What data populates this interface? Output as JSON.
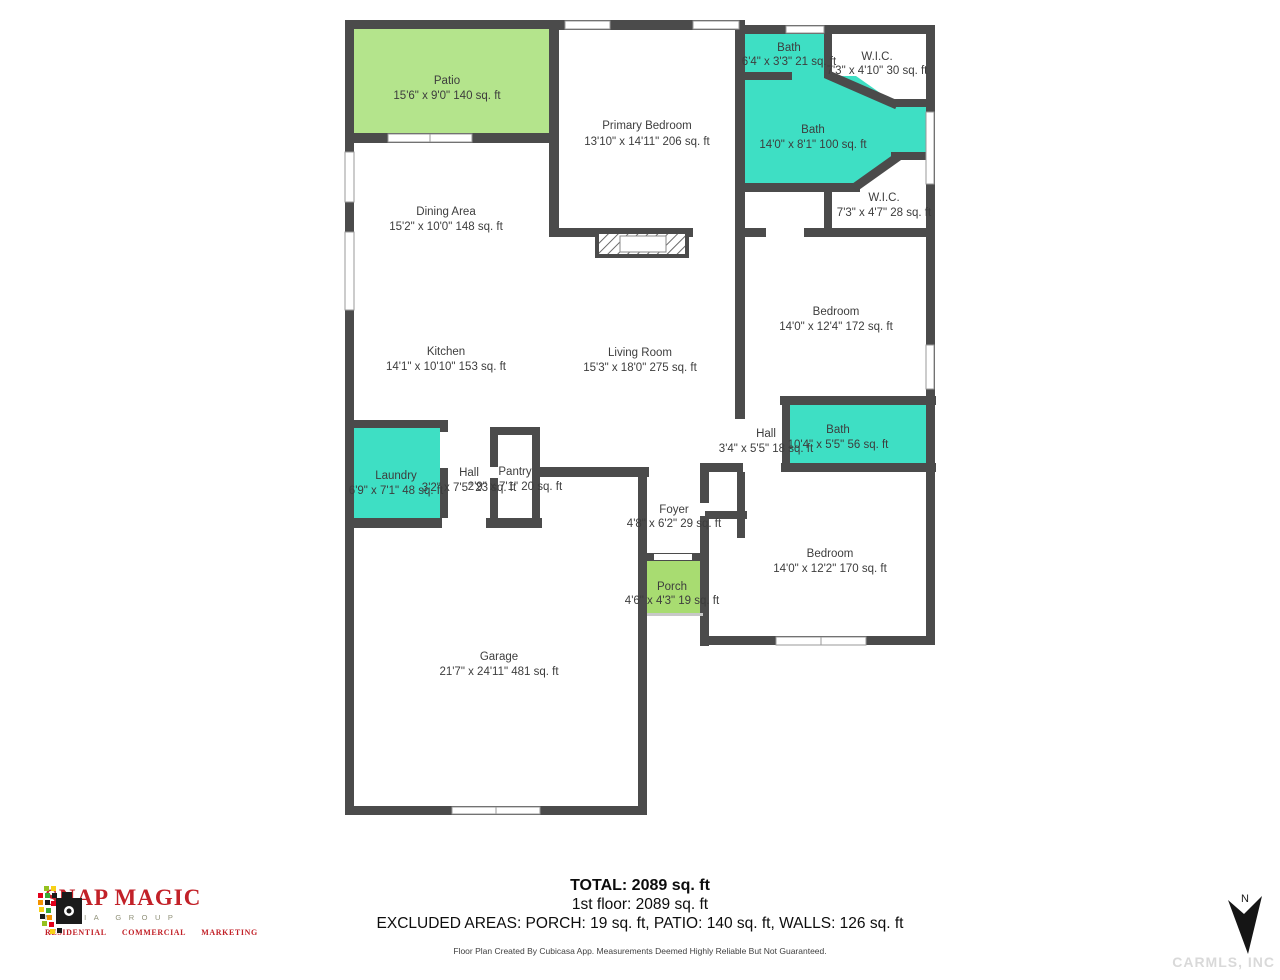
{
  "plan": {
    "rooms": {
      "patio": {
        "name": "Patio",
        "dims": "15'6\" x 9'0\" 140 sq. ft"
      },
      "primary": {
        "name": "Primary Bedroom",
        "dims": "13'10\" x 14'11\" 206 sq. ft"
      },
      "bath1": {
        "name": "Bath",
        "dims": "6'4\" x 3'3\" 21 sq. ft"
      },
      "wic1": {
        "name": "W.I.C.",
        "dims": "7'3\" x 4'10\" 30 sq. ft"
      },
      "bath2": {
        "name": "Bath",
        "dims": "14'0\" x 8'1\" 100 sq. ft"
      },
      "wic2": {
        "name": "W.I.C.",
        "dims": "7'3\" x 4'7\" 28 sq. ft"
      },
      "dining": {
        "name": "Dining Area",
        "dims": "15'2\" x 10'0\" 148 sq. ft"
      },
      "bedroom1": {
        "name": "Bedroom",
        "dims": "14'0\" x 12'4\" 172 sq. ft"
      },
      "kitchen": {
        "name": "Kitchen",
        "dims": "14'1\" x 10'10\" 153 sq. ft"
      },
      "living": {
        "name": "Living Room",
        "dims": "15'3\" x 18'0\" 275 sq. ft"
      },
      "hall1": {
        "name": "Hall",
        "dims": "3'4\" x 5'5\" 18 sq. ft"
      },
      "bath3": {
        "name": "Bath",
        "dims": "10'4\" x 5'5\" 56 sq. ft"
      },
      "laundry": {
        "name": "Laundry",
        "dims": "6'9\" x 7'1\" 48 sq. ft"
      },
      "hall2": {
        "name": "Hall",
        "dims": "3'2\" x 7'5\" 23 sq. ft"
      },
      "pantry": {
        "name": "Pantry",
        "dims": "2'9\" x 7'1\" 20 sq. ft"
      },
      "foyer": {
        "name": "Foyer",
        "dims": "4'8\" x 6'2\" 29 sq. ft"
      },
      "porch": {
        "name": "Porch",
        "dims": "4'6\" x 4'3\" 19 sq. ft"
      },
      "bedroom2": {
        "name": "Bedroom",
        "dims": "14'0\" x 12'2\" 170 sq. ft"
      },
      "garage": {
        "name": "Garage",
        "dims": "21'7\" x 24'11\" 481 sq. ft"
      }
    },
    "colors": {
      "wall": "#4b4b4b",
      "bath": "#3edfc4",
      "patio": "#b4e48c",
      "porch": "#a8dc71",
      "label": "#3d3d3d",
      "logo_red": "#c22128",
      "watermark": "#d9d9d9"
    }
  },
  "summary": {
    "total": "TOTAL: 2089 sq. ft",
    "floor": "1st floor: 2089 sq. ft",
    "excluded": "EXCLUDED AREAS: PORCH: 19 sq. ft, PATIO: 140 sq. ft, WALLS: 126 sq. ft",
    "disclaimer": "Floor Plan Created By Cubicasa App. Measurements Deemed Highly Reliable But Not Guaranteed."
  },
  "logo": {
    "title": "SNAP MAGIC",
    "subtitle": "MEDIA GROUP",
    "tagline": "RESIDENTIAL COMMERCIAL MARKETING"
  },
  "compass": {
    "label": "N"
  },
  "watermark": {
    "text": "CARMLS, INC"
  }
}
